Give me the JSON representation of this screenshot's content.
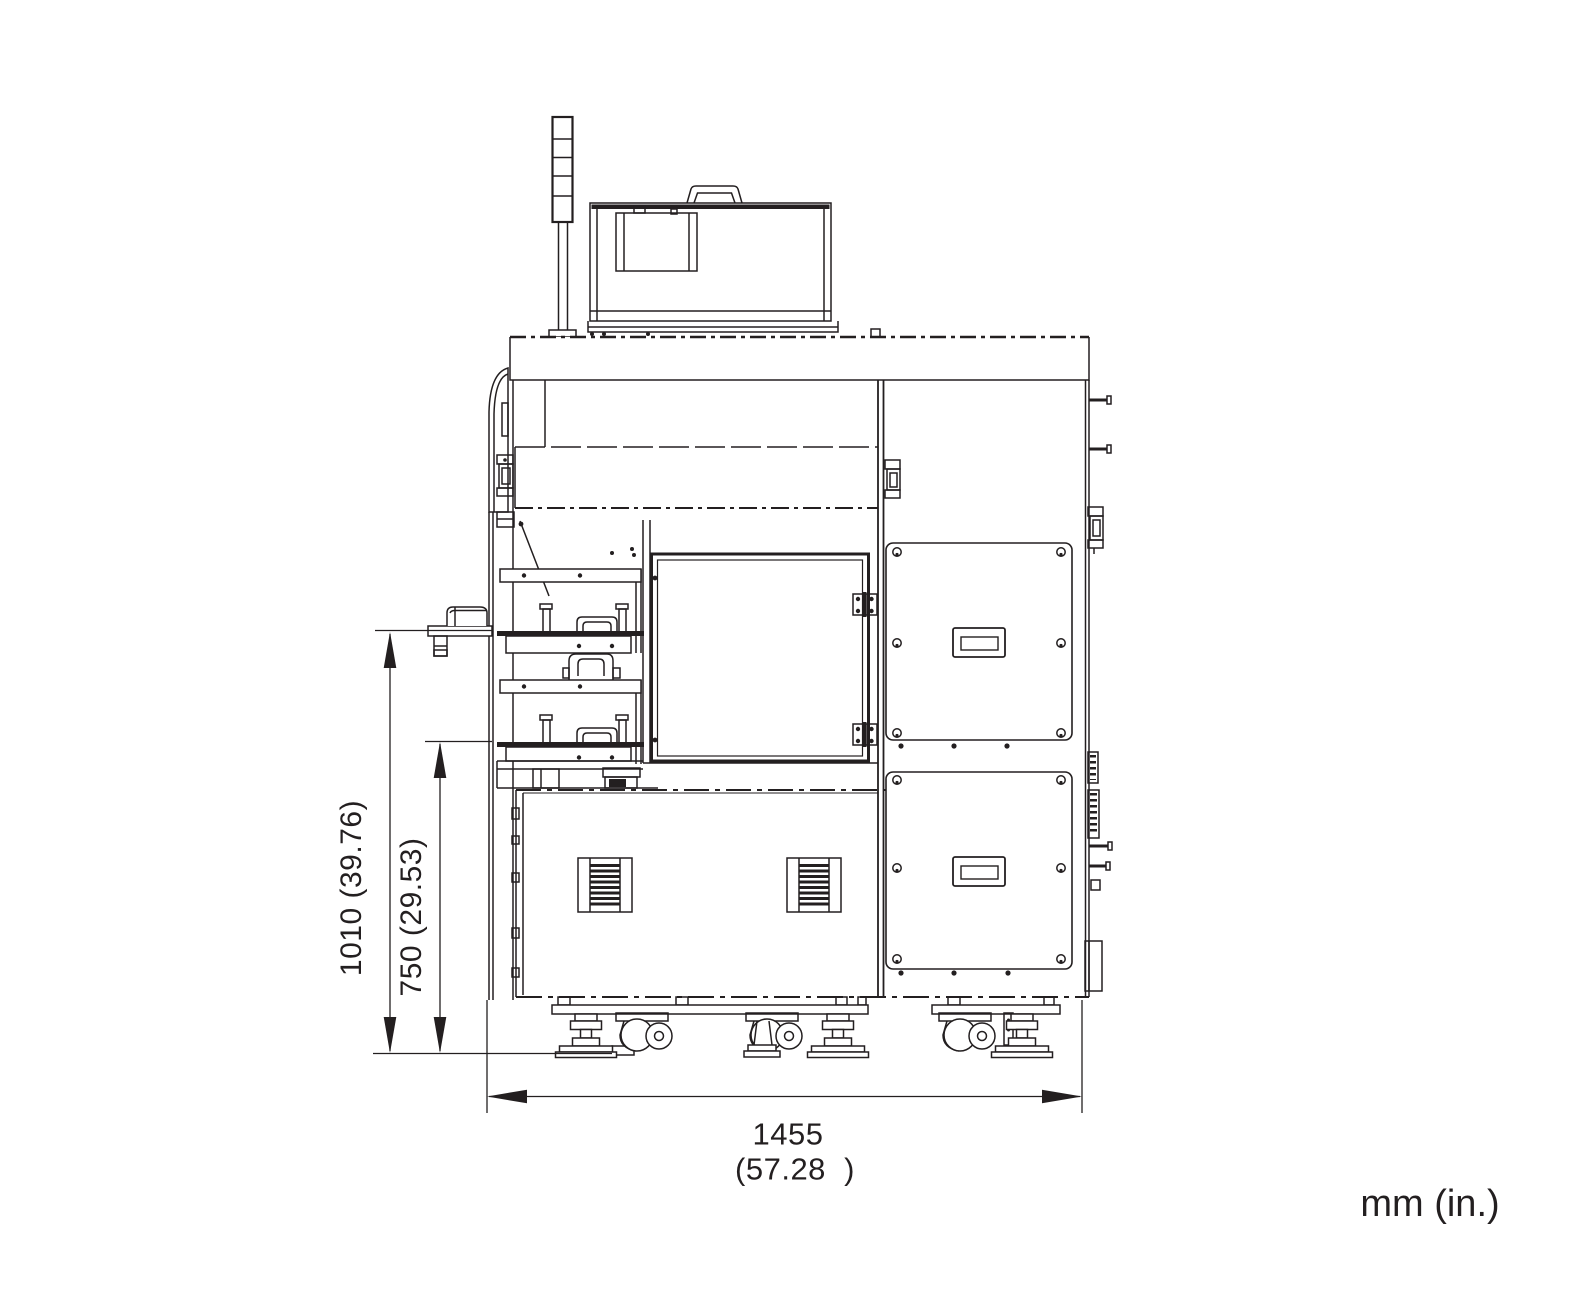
{
  "units_label": "mm (in.)",
  "dimensions": {
    "height_1010": {
      "label": "1010 (39.76)",
      "value_mm": "1010",
      "value_in": "39.76",
      "orientation": "vertical"
    },
    "height_750": {
      "label": "750 (29.53)",
      "value_mm": "750",
      "value_in": "29.53",
      "orientation": "vertical"
    },
    "width_1455": {
      "line1": "1455",
      "line2": "(57.28  )",
      "value_mm": "1455",
      "value_in": "57.28",
      "orientation": "horizontal"
    }
  },
  "colors": {
    "line": "#231f20",
    "background": "#ffffff"
  }
}
